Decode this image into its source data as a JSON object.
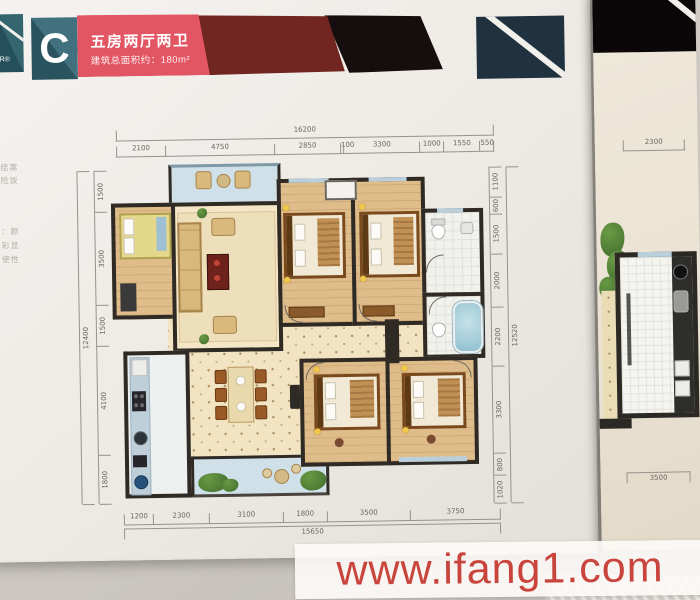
{
  "header": {
    "logo_fragment": "R®",
    "unit_letter": "C",
    "title": "五房两厅两卫",
    "subtitle": "建筑总面积约：180m²"
  },
  "edge_text": {
    "fragments": [
      "结蒿",
      "险饭",
      "：颜",
      "彩显",
      "使性"
    ]
  },
  "plan": {
    "dims": {
      "top": {
        "overall": "16200",
        "segments": [
          "2100",
          "4750",
          "2850",
          "100",
          "3300",
          "1000",
          "1550",
          "550"
        ]
      },
      "bottom": {
        "overall": "15650",
        "segments": [
          "1200",
          "2300",
          "3100",
          "1800",
          "3500",
          "3750"
        ]
      },
      "left": {
        "overall": "12400",
        "segments": [
          "1500",
          "3500",
          "1500",
          "4100",
          "1800"
        ]
      },
      "right": {
        "overall": "12520",
        "segments": [
          "1100",
          "600",
          "1500",
          "2000",
          "2200",
          "3300",
          "800",
          "1020"
        ]
      }
    }
  },
  "page2": {
    "dims": {
      "top": "2300",
      "bottom": "3500"
    }
  },
  "watermark": {
    "text": "www.ifang1.com"
  },
  "colors": {
    "teal": "#3e6e7c",
    "pink": "#e25562",
    "maroon": "#722622",
    "band_black": "#150d0e",
    "watermark_red": "#c9443c",
    "wall": "#2f2a24"
  }
}
